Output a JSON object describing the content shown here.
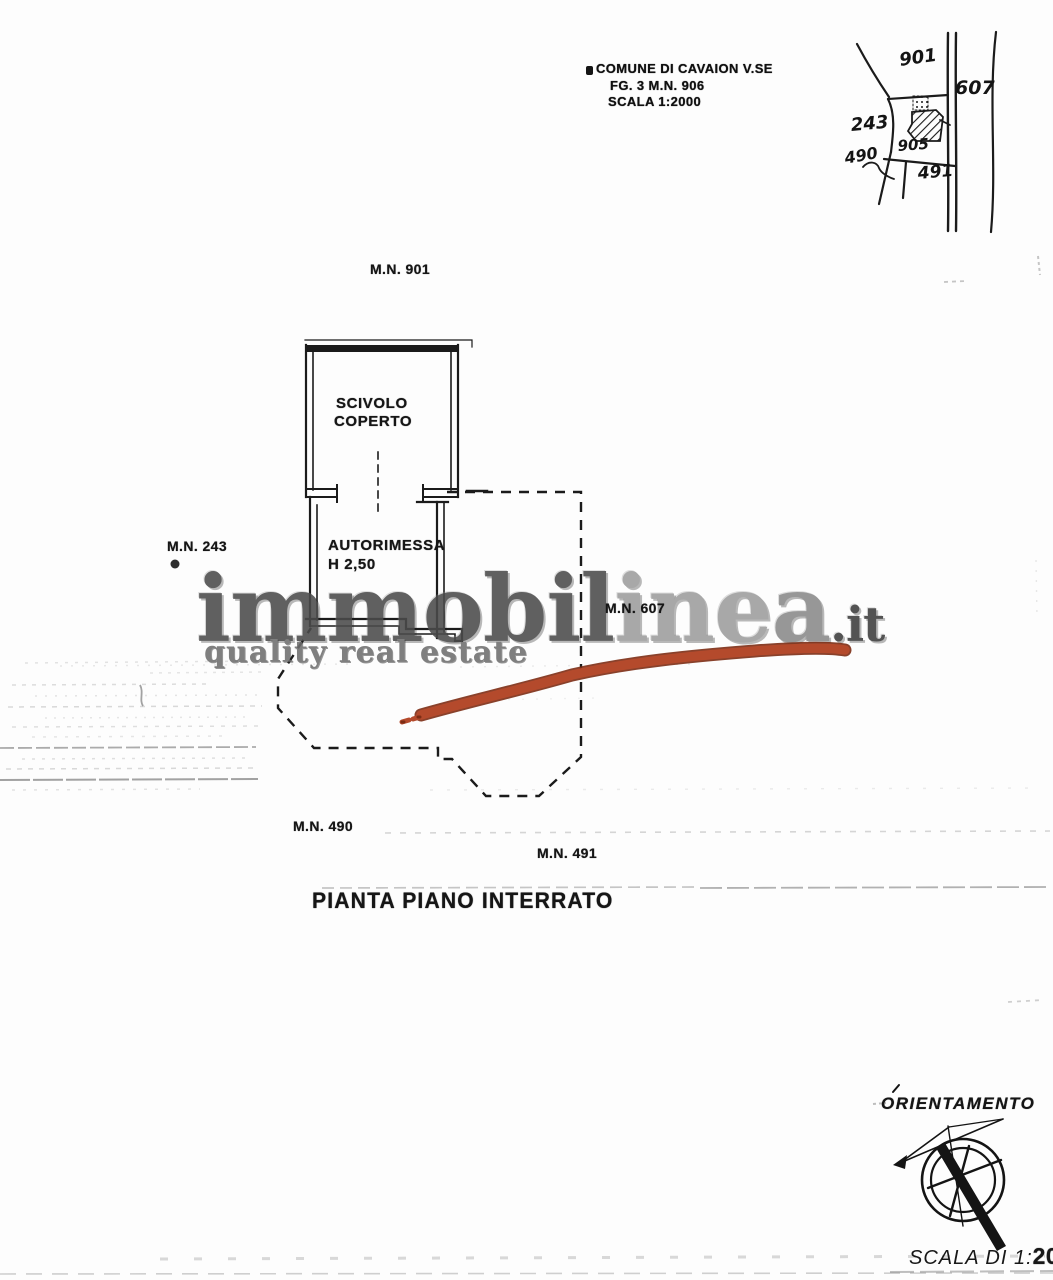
{
  "header": {
    "municipality_line": "COMUNE DI CAVAION V.SE",
    "sheet_line": "FG. 3 M.N. 906",
    "scale_line": "SCALA 1:2000"
  },
  "sketch": {
    "parcels": {
      "p901": "901",
      "p607": "607",
      "p243": "243",
      "p905": "905",
      "p490": "490",
      "p491": "491"
    }
  },
  "plan": {
    "label_mn901": "M.N. 901",
    "label_mn243": "M.N. 243",
    "label_mn607": "M.N. 607",
    "label_mn490": "M.N. 490",
    "label_mn491": "M.N. 491",
    "room_scivolo_line1": "SCIVOLO",
    "room_scivolo_line2": "COPERTO",
    "room_autorimessa": "AUTORIMESSA",
    "room_autorimessa_height": "H 2,50",
    "title": "PIANTA PIANO INTERRATO"
  },
  "watermark": {
    "brand_dark": "immobil",
    "brand_light": "ine",
    "brand_mid": "a",
    "tld": ".it",
    "tagline": "quality real estate"
  },
  "compass": {
    "label": "ORIENTAMENTO"
  },
  "scale_note": {
    "prefix": "SCALA DI 1:",
    "value": "200"
  },
  "colors": {
    "highlight": "#b44a2c",
    "highlight_edge": "#7c2c14",
    "ink": "#1b1b1b",
    "watermark_dark": "#4b4b4b",
    "watermark_light": "#9d9d9d",
    "paper": "#fdfdfd"
  }
}
